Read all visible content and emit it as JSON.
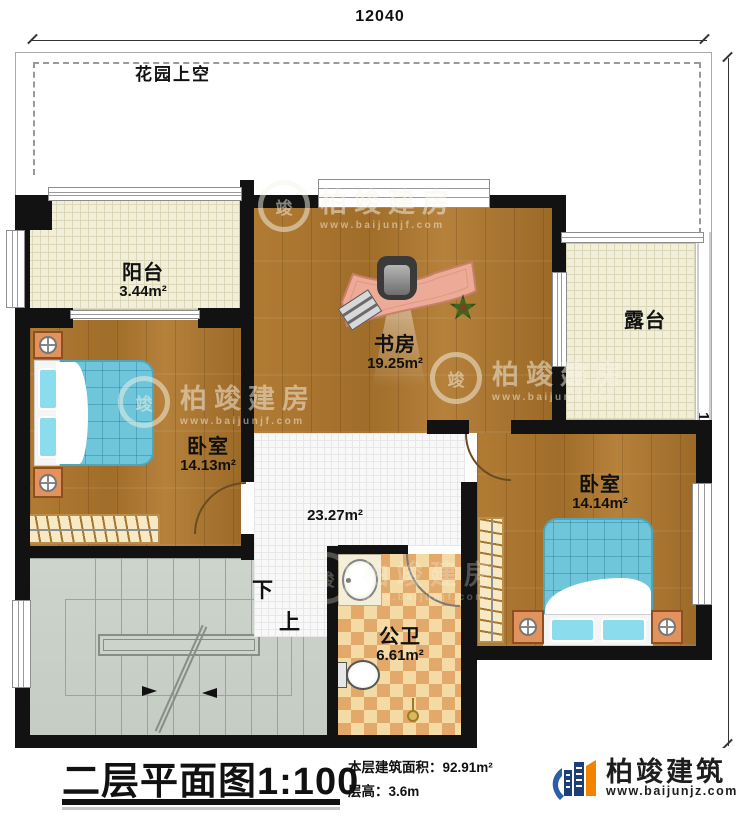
{
  "dimensions": {
    "top": "12040",
    "right": "12440"
  },
  "garden": {
    "label": "花园上空"
  },
  "rooms": {
    "balcony": {
      "name": "阳台",
      "area": "3.44m²"
    },
    "study": {
      "name": "书房",
      "area": "19.25m²"
    },
    "terrace": {
      "name": "露台"
    },
    "bedroom_left": {
      "name": "卧室",
      "area": "14.13m²"
    },
    "bedroom_right": {
      "name": "卧室",
      "area": "14.14m²"
    },
    "hallway": {
      "area": "23.27m²"
    },
    "bathroom": {
      "name": "公卫",
      "area": "6.61m²"
    }
  },
  "stairs": {
    "down_label": "下",
    "up_label": "上"
  },
  "watermark": {
    "brand": "柏竣建房",
    "url": "www.baijunjf.com",
    "ring_glyph": "竣"
  },
  "footer": {
    "title": "二层平面图",
    "scale": "1:100",
    "area_label": "本层建筑面积：",
    "area_value": "92.91m²",
    "floor_height_label": "层高：",
    "floor_height_value": "3.6m",
    "brand": "柏竣建筑",
    "brand_url": "www.baijunjz.com"
  },
  "colors": {
    "wall": "#121212",
    "accent_blue": "#2b5fa8",
    "accent_orange": "#f08300"
  }
}
